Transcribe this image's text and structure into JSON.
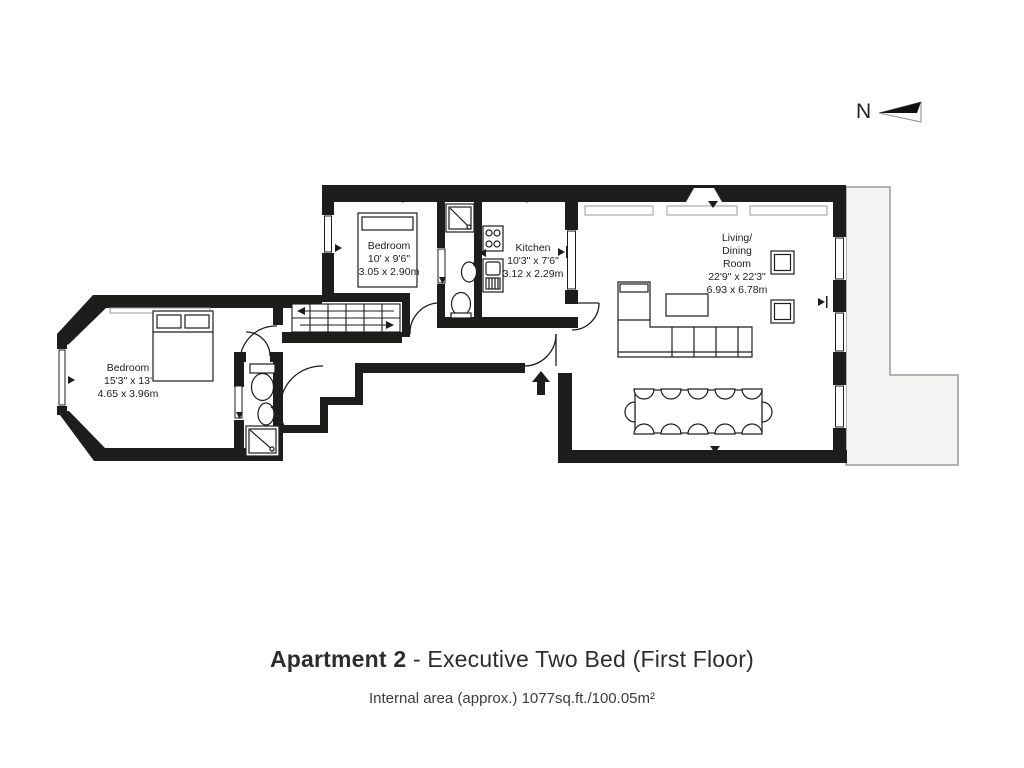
{
  "compass": {
    "label": "N"
  },
  "rooms": {
    "bedroom_small": {
      "name": "Bedroom",
      "imperial": "10' x 9'6\"",
      "metric": "3.05 x 2.90m"
    },
    "kitchen": {
      "name": "Kitchen",
      "imperial": "10'3\" x 7'6\"",
      "metric": "3.12 x 2.29m"
    },
    "living": {
      "name_line1": "Living/",
      "name_line2": "Dining",
      "name_line3": "Room",
      "imperial": "22'9\" x 22'3\"",
      "metric": "6.93 x 6.78m"
    },
    "bedroom_large": {
      "name": "Bedroom",
      "imperial": "15'3\" x 13'",
      "metric": "4.65 x 3.96m"
    }
  },
  "footer": {
    "title_bold": "Apartment 2",
    "title_rest": " - Executive Two Bed (First Floor)",
    "subtitle": "Internal area (approx.) 1077sq.ft./100.05m²"
  },
  "colors": {
    "wall": "#1d1d1b",
    "terrace_fill": "#f4f4f2",
    "terrace_stroke": "#9a9a9a"
  }
}
